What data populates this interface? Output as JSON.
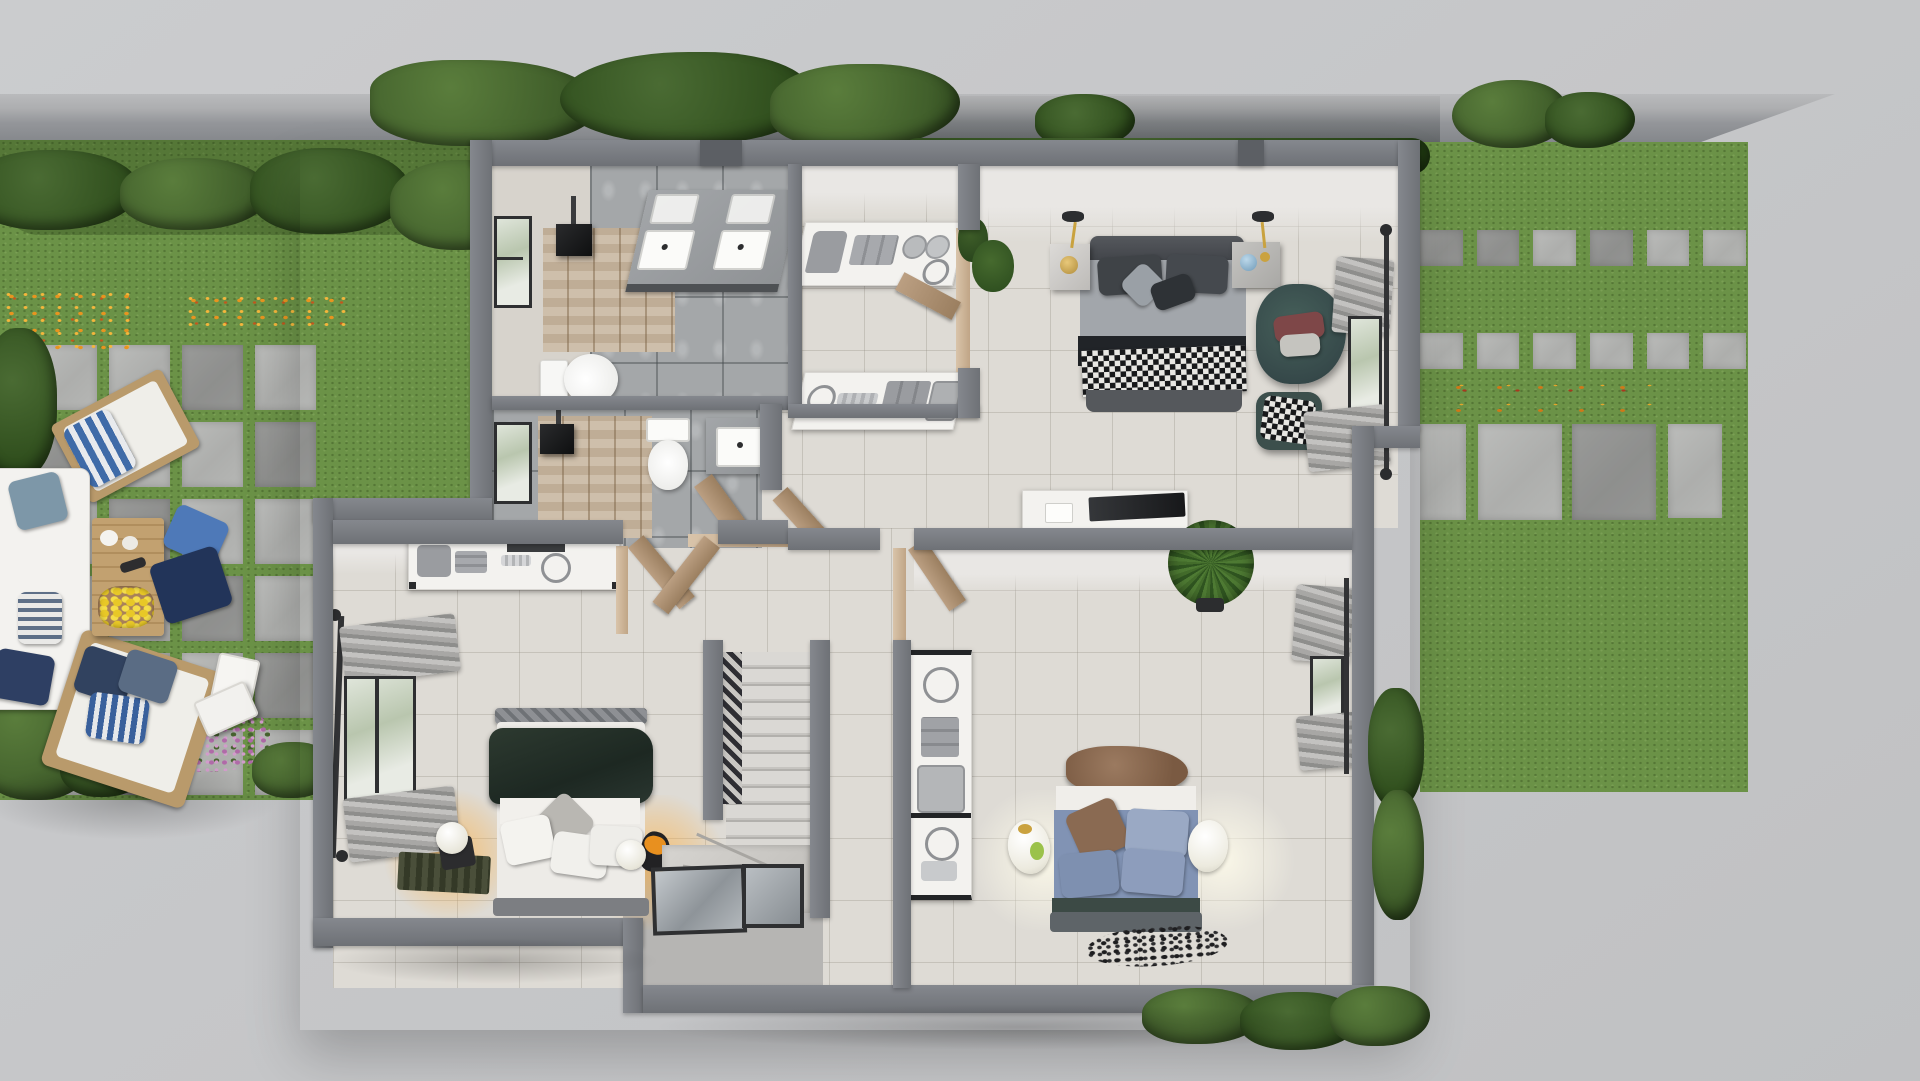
{
  "scene": {
    "title": "Top-down 3D render of a residential floor plan",
    "view": "overhead architectural visualization",
    "rooms": [
      {
        "name": "master-bathroom",
        "items": [
          "double-vanity",
          "toilet",
          "shower-head",
          "window",
          "wood-floor-inlay"
        ]
      },
      {
        "name": "second-bathroom",
        "items": [
          "vanity",
          "toilet",
          "wall-sink",
          "shower-head",
          "window",
          "open-door"
        ]
      },
      {
        "name": "walk-in-closet",
        "items": [
          "island-counter-upper",
          "island-counter-lower",
          "folded-clothes",
          "baskets",
          "open-door"
        ]
      },
      {
        "name": "master-bedroom",
        "items": [
          "double-bed",
          "nightstand-left",
          "nightstand-right",
          "pendant-lamps",
          "armchair",
          "ottoman",
          "tv-console",
          "curtained-window",
          "potted-plant"
        ]
      },
      {
        "name": "bedroom-left",
        "items": [
          "double-bed",
          "dresser",
          "glowing-table-lamps",
          "curtained-window",
          "rug",
          "double-doors"
        ]
      },
      {
        "name": "bedroom-right",
        "items": [
          "double-bed",
          "shelf-unit",
          "egg-lamps",
          "floor-scatter",
          "curtained-window",
          "fan-palm",
          "door"
        ]
      },
      {
        "name": "stair-core",
        "items": [
          "staircase",
          "patterned-runner",
          "landing",
          "entry-glass-panels"
        ]
      }
    ],
    "outdoor": {
      "left-garden": [
        "lawn",
        "boundary-wall",
        "hedges",
        "flowering-shrubs",
        "orange-flowers",
        "paver-patio",
        "deck-chair",
        "l-shaped-sofa",
        "coffee-table",
        "lemon-tray",
        "floor-pillows",
        "lanterns",
        "lounge-chair",
        "palm-fronds",
        "purple-flowers"
      ],
      "right-garden": [
        "lawn",
        "stepping-stone-rows",
        "large-slabs",
        "fallen-leaves",
        "ivy-on-wall",
        "hedge-strip"
      ],
      "surroundings": [
        "concrete-apron",
        "street-wall",
        "bottom-hedge"
      ]
    }
  },
  "palette": {
    "concrete": "#c7c8ca",
    "grass": "#6b9247",
    "hedge": "#415f2b",
    "hedge-light": "#5a7d3c",
    "floor": "#dedbd5",
    "bathtile": "#a4a7a9",
    "wood": "#c9b8a2",
    "wall-dark": "#6e7176",
    "duvet-green": "#27312a",
    "duvet-denim": "#8193b4",
    "chair-teal": "#3c4f4c",
    "accent-amber": "#f2a93b",
    "door-tan": "#b3977b"
  }
}
